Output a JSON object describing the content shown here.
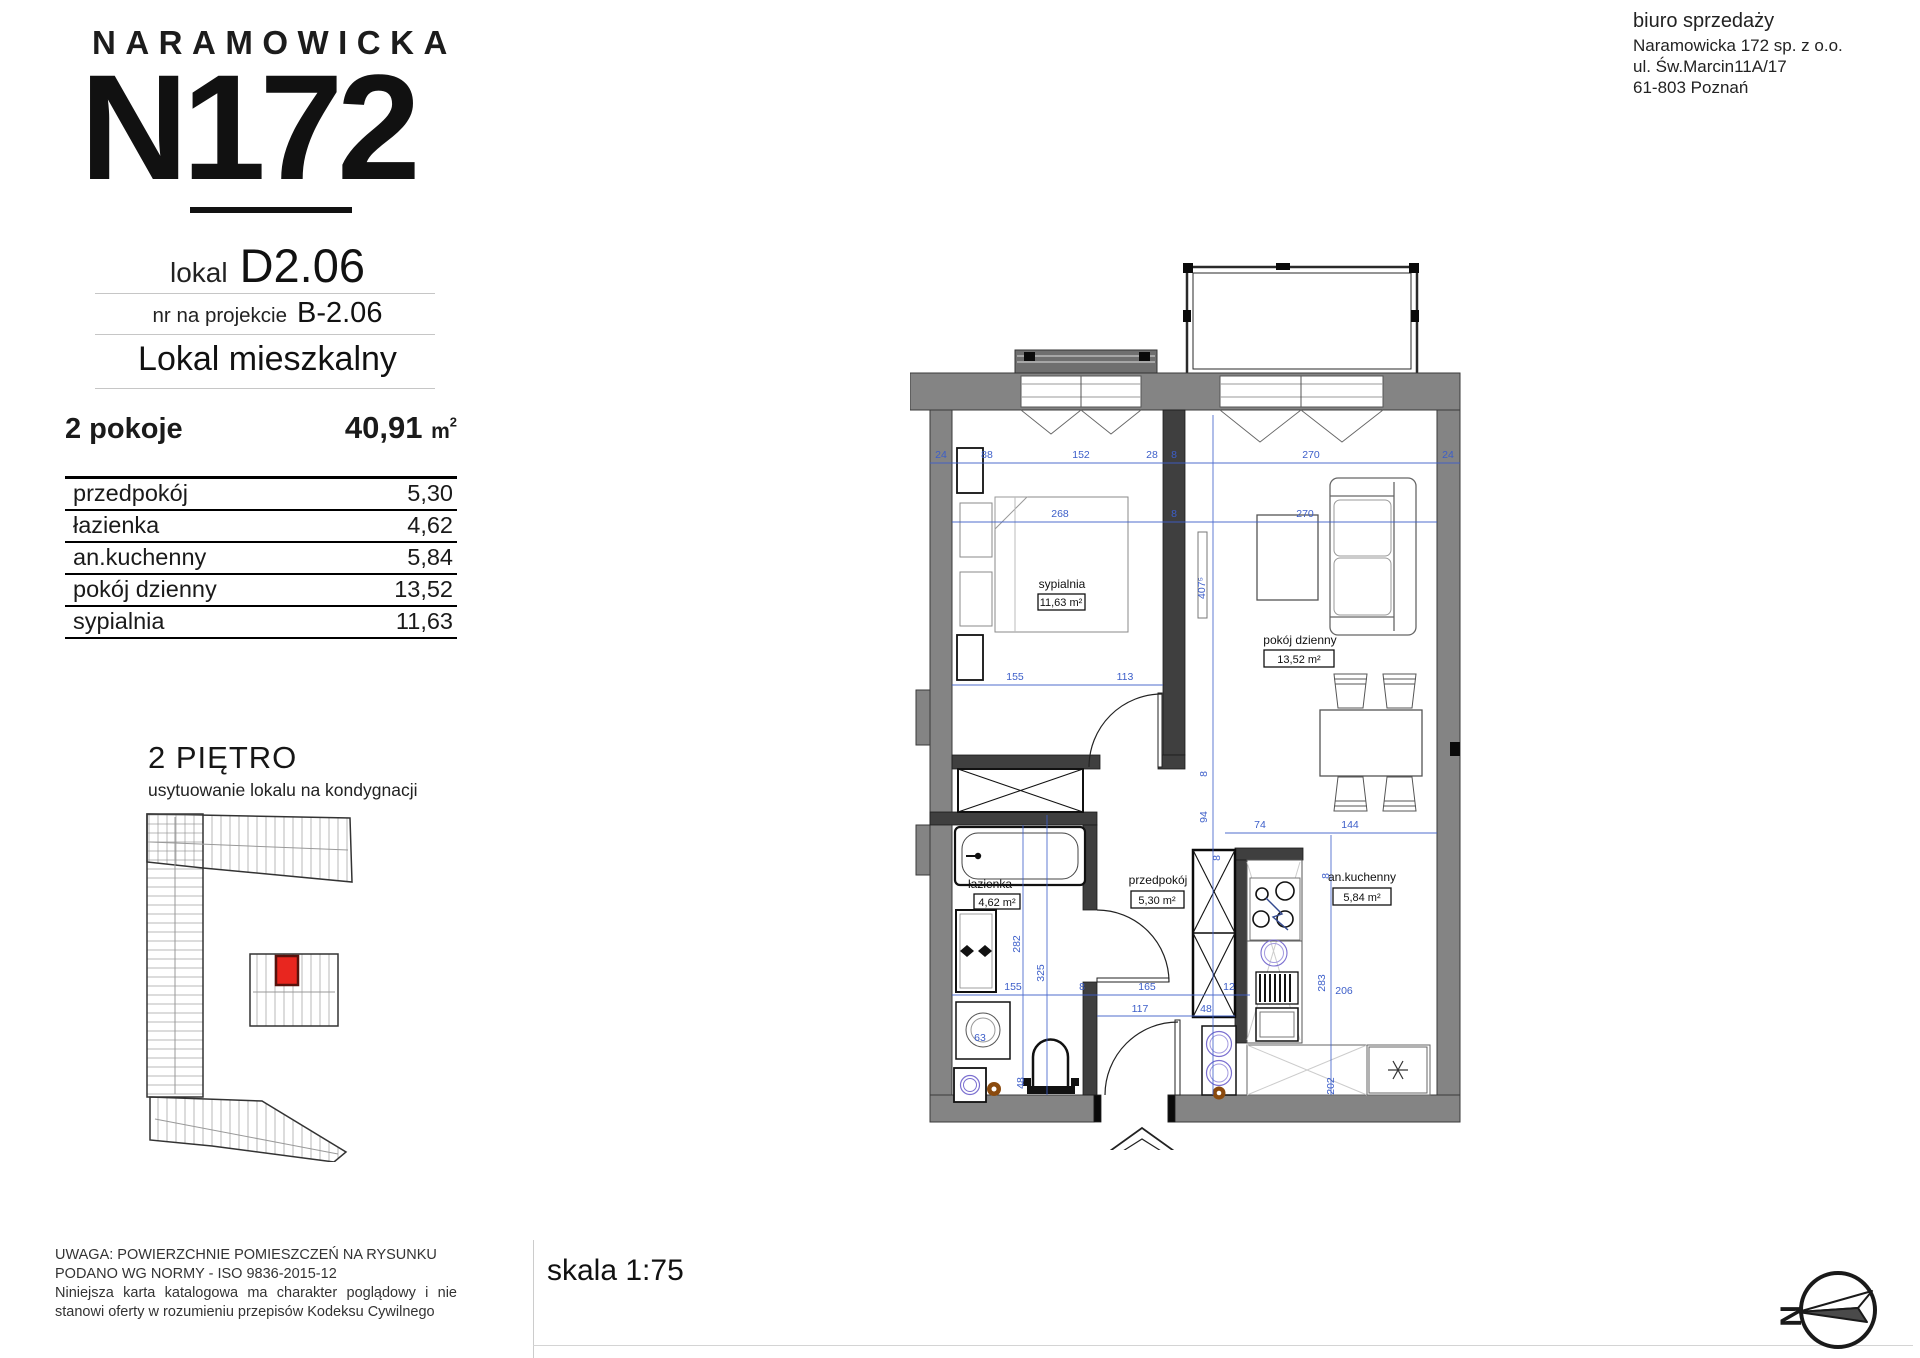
{
  "header": {
    "brand": "NARAMOWICKA",
    "logo_number": "N172",
    "office": {
      "title": "biuro sprzedaży",
      "lines": [
        "Naramowicka 172 sp. z o.o.",
        "ul. Św.Marcin11A/17",
        "61-803 Poznań"
      ]
    }
  },
  "unit": {
    "lokal_label": "lokal",
    "lokal_number": "D2.06",
    "project_label": "nr na projekcie",
    "project_number": "B-2.06",
    "type": "Lokal mieszkalny",
    "rooms_count": "2 pokoje",
    "total_area_value": "40,91",
    "total_area_unit": "m",
    "total_area_sup": "2"
  },
  "rooms_table": [
    {
      "name": "przedpokój",
      "area": "5,30"
    },
    {
      "name": "łazienka",
      "area": "4,62"
    },
    {
      "name": "an.kuchenny",
      "area": "5,84"
    },
    {
      "name": "pokój dzienny",
      "area": "13,52"
    },
    {
      "name": "sypialnia",
      "area": "11,63"
    }
  ],
  "floor_section": {
    "title": "2 PIĘTRO",
    "subtitle": "usytuowanie lokalu na kondygnacji",
    "highlight_color": "#e8261f"
  },
  "plan": {
    "labels": [
      {
        "name": "sypialnia",
        "area": "11,63 m²"
      },
      {
        "name": "pokój dzienny",
        "area": "13,52 m²"
      },
      {
        "name": "przedpokój",
        "area": "5,30 m²"
      },
      {
        "name": "an.kuchenny",
        "area": "5,84 m²"
      },
      {
        "name": "łazienka",
        "area": "4,62 m²"
      }
    ],
    "entrance_label": "B-2.06",
    "dimension_color": "#3c5ec9",
    "dims": [
      {
        "t": "24",
        "x": 31,
        "y": 208
      },
      {
        "t": "88",
        "x": 77,
        "y": 208
      },
      {
        "t": "152",
        "x": 171,
        "y": 208
      },
      {
        "t": "28",
        "x": 242,
        "y": 208
      },
      {
        "t": "8",
        "x": 264,
        "y": 208
      },
      {
        "t": "270",
        "x": 401,
        "y": 208
      },
      {
        "t": "24",
        "x": 538,
        "y": 208
      },
      {
        "t": "268",
        "x": 150,
        "y": 267
      },
      {
        "t": "8",
        "x": 264,
        "y": 267
      },
      {
        "t": "270",
        "x": 395,
        "y": 267
      },
      {
        "t": "155",
        "x": 105,
        "y": 430
      },
      {
        "t": "113",
        "x": 215,
        "y": 430
      },
      {
        "t": "407⁵",
        "x": 295,
        "y": 338,
        "r": -90
      },
      {
        "t": "8",
        "x": 297,
        "y": 524,
        "r": -90
      },
      {
        "t": "94",
        "x": 297,
        "y": 567,
        "r": -90
      },
      {
        "t": "8",
        "x": 310,
        "y": 608,
        "r": -90
      },
      {
        "t": "74",
        "x": 350,
        "y": 578
      },
      {
        "t": "144",
        "x": 440,
        "y": 578
      },
      {
        "t": "8",
        "x": 419,
        "y": 626,
        "r": -90
      },
      {
        "t": "283",
        "x": 415,
        "y": 733,
        "r": -90
      },
      {
        "t": "206",
        "x": 434,
        "y": 744
      },
      {
        "t": "202",
        "x": 424,
        "y": 836,
        "r": -90
      },
      {
        "t": "282",
        "x": 110,
        "y": 694,
        "r": -90
      },
      {
        "t": "325",
        "x": 134,
        "y": 723,
        "r": -90
      },
      {
        "t": "155",
        "x": 103,
        "y": 740
      },
      {
        "t": "8",
        "x": 172,
        "y": 740
      },
      {
        "t": "165",
        "x": 237,
        "y": 740
      },
      {
        "t": "12",
        "x": 319,
        "y": 740
      },
      {
        "t": "117",
        "x": 230,
        "y": 762
      },
      {
        "t": "48",
        "x": 296,
        "y": 762
      },
      {
        "t": "48",
        "x": 114,
        "y": 833,
        "r": -90
      },
      {
        "t": "63",
        "x": 70,
        "y": 791
      }
    ]
  },
  "footer": {
    "scale_label": "skala 1:75",
    "disclaimer_line1": "UWAGA: POWIERZCHNIE POMIESZCZEŃ NA RYSUNKU",
    "disclaimer_line2": "PODANO WG NORMY - ISO 9836-2015-12",
    "disclaimer_line3": "Niniejsza karta katalogowa ma charakter poglądowy i nie stanowi oferty w rozumieniu przepisów Kodeksu Cywilnego",
    "compass_letter": "N"
  }
}
